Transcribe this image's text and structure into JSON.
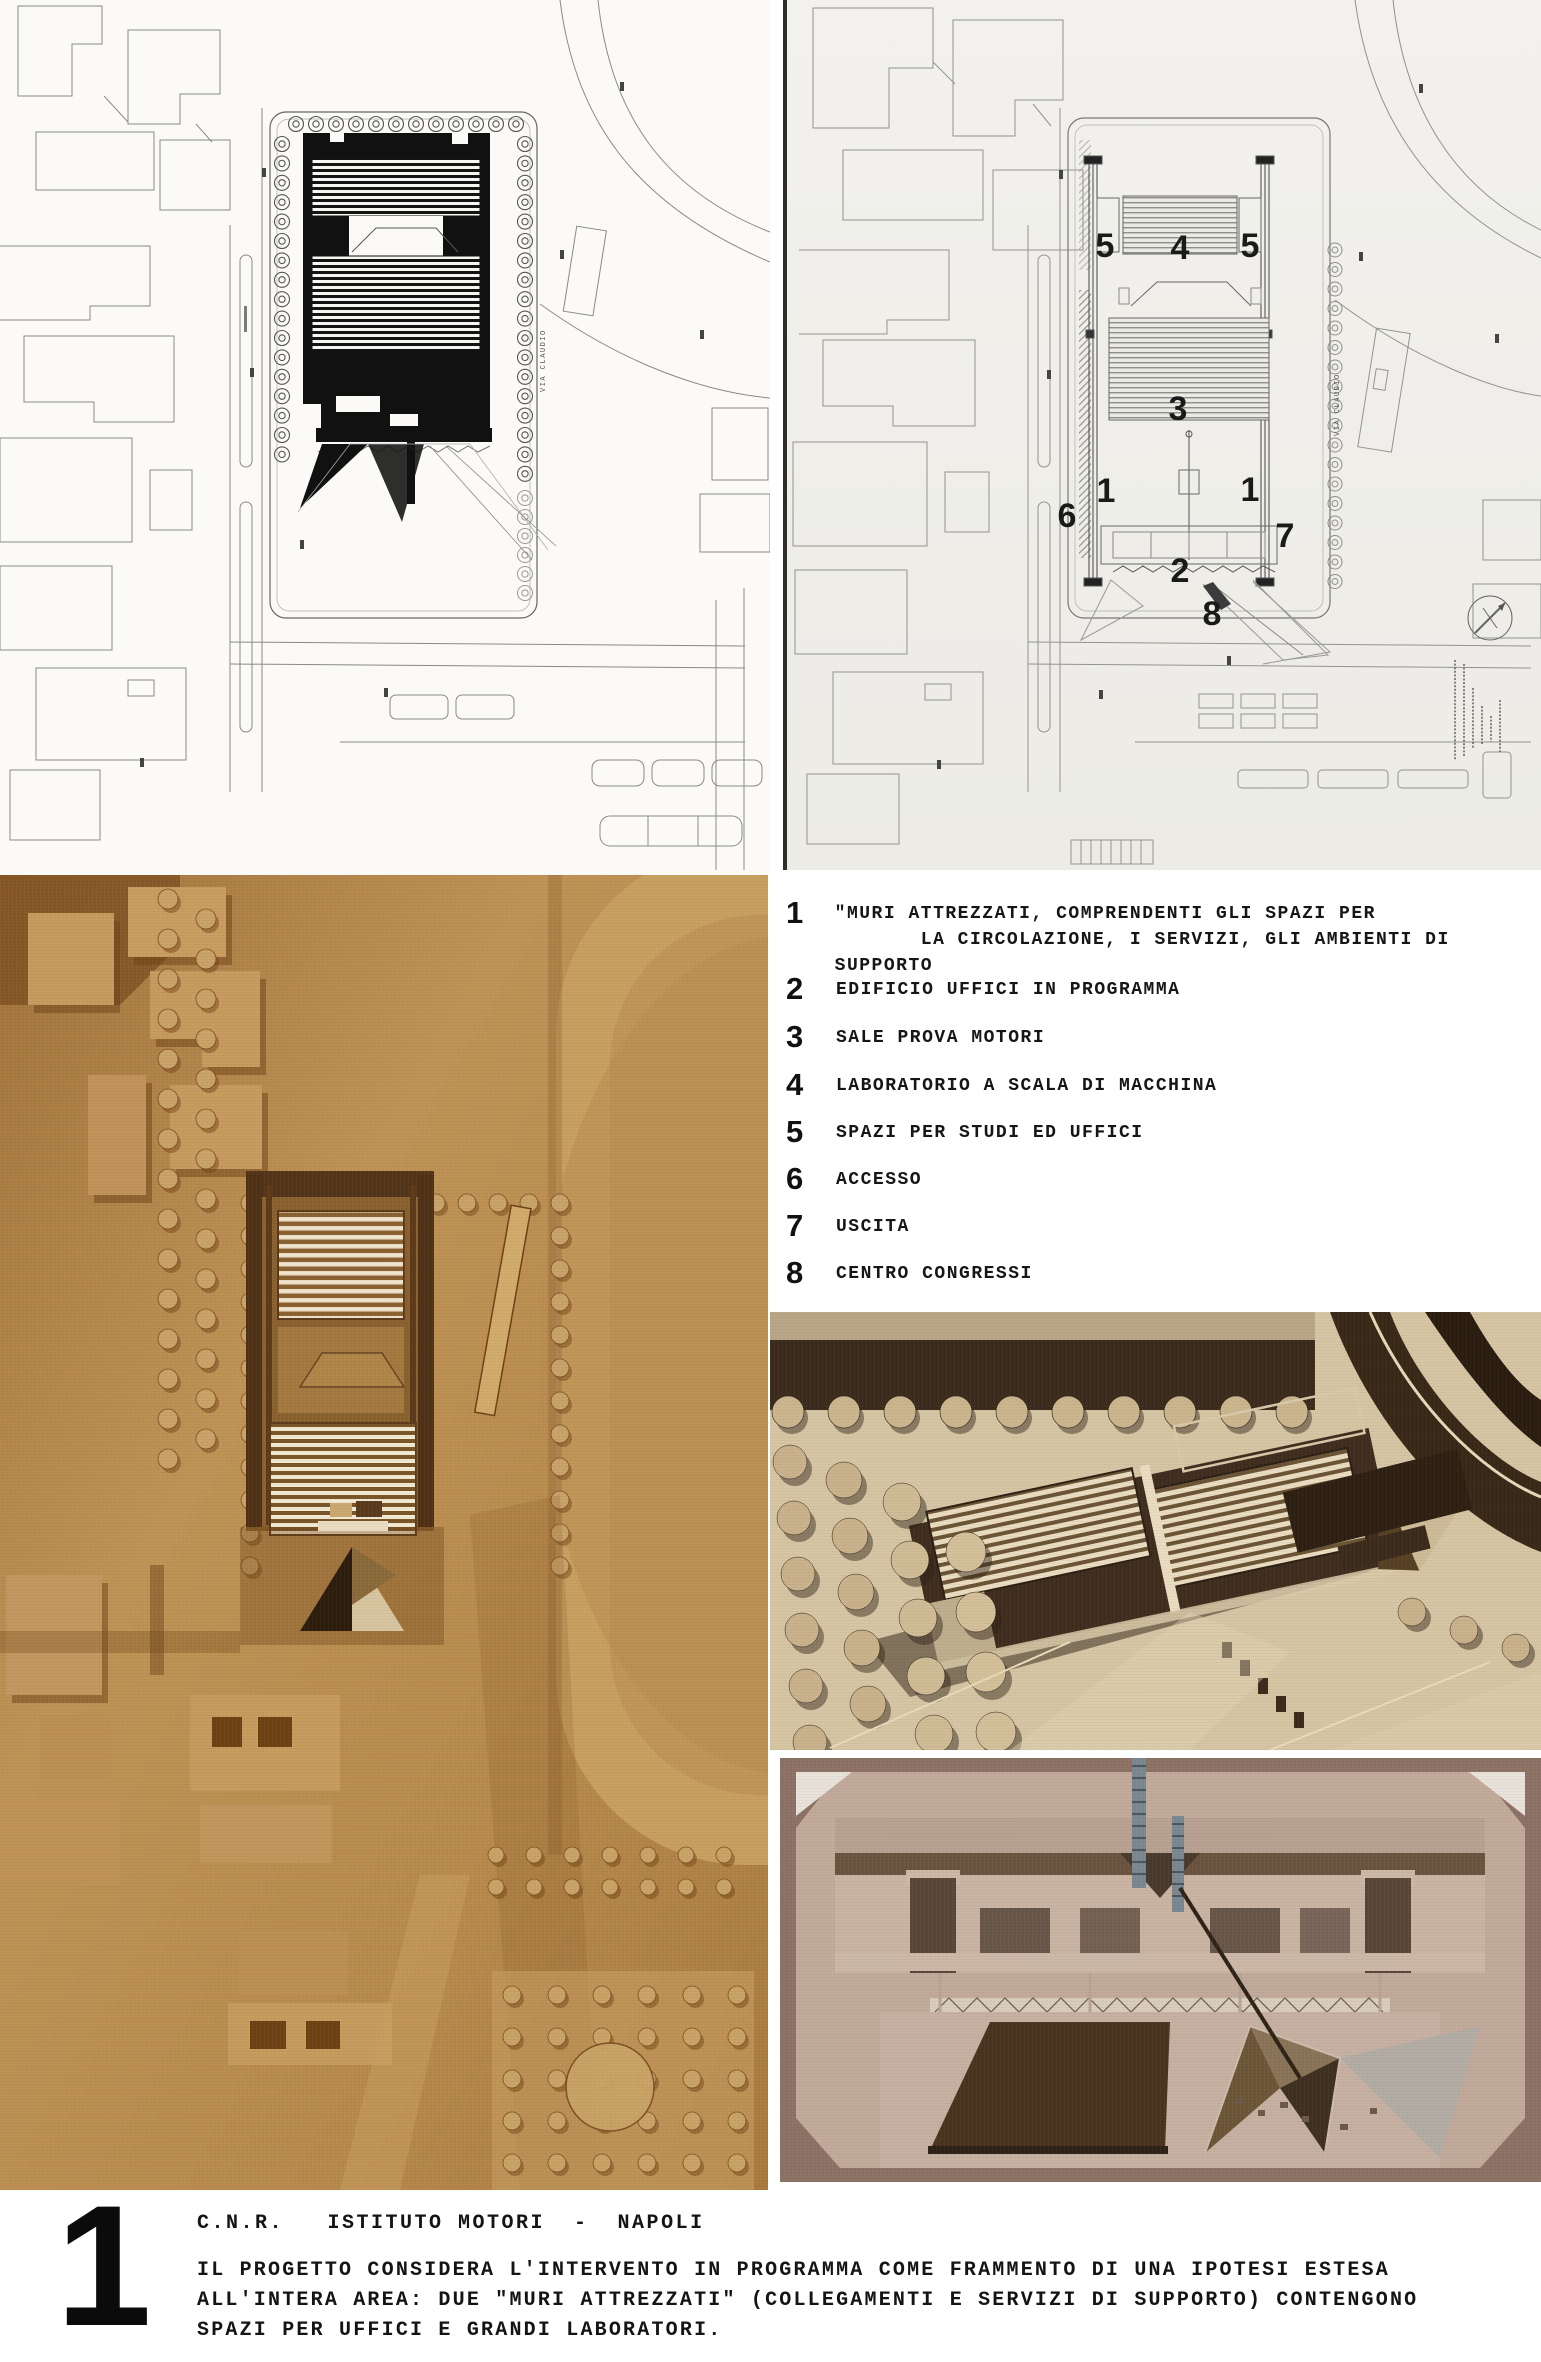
{
  "page": {
    "background": "#ffffff"
  },
  "plans": {
    "left": {
      "description": "site-plan-black-building-mass",
      "street_label": "VIA CLAUDIO"
    },
    "right": {
      "description": "site-plan-numbered-program",
      "street_label": "VIA CLAUDIO",
      "callouts": [
        "5",
        "4",
        "5",
        "3",
        "1",
        "1",
        "6",
        "7",
        "2",
        "8"
      ]
    }
  },
  "legend": {
    "items": [
      {
        "num": "1",
        "text": "\"MURI ATTREZZATI, COMPRENDENTI GLI SPAZI PER\n       LA CIRCOLAZIONE, I SERVIZI, GLI AMBIENTI DI SUPPORTO"
      },
      {
        "num": "2",
        "text": "EDIFICIO UFFICI IN PROGRAMMA"
      },
      {
        "num": "3",
        "text": "SALE PROVA MOTORI"
      },
      {
        "num": "4",
        "text": "LABORATORIO A SCALA DI MACCHINA"
      },
      {
        "num": "5",
        "text": "SPAZI PER STUDI ED UFFICI"
      },
      {
        "num": "6",
        "text": "ACCESSO"
      },
      {
        "num": "7",
        "text": "USCITA"
      },
      {
        "num": "8",
        "text": "CENTRO CONGRESSI"
      }
    ]
  },
  "caption": {
    "figure_number": "1",
    "title": "C.N.R.   ISTITUTO MOTORI  -  NAPOLI",
    "body": "IL PROGETTO CONSIDERA L'INTERVENTO IN PROGRAMMA COME FRAMMENTO DI UNA IPOTESI ESTESA\nALL'INTERA AREA: DUE \"MURI ATTREZZATI\" (COLLEGAMENTI E SERVIZI DI SUPPORTO) CONTENGONO\nSPAZI PER UFFICI E GRANDI LABORATORI."
  },
  "colors": {
    "plan_paper_left": "#fbfaf7",
    "plan_paper_right": "#f0efeb",
    "plan_ink": "#111111",
    "wood_model": "#b5834f",
    "sepia_photo": "#d6c5a3",
    "pink_photo": "#bfa698",
    "pyramid_dark": "#4a3420",
    "text_black": "#141414"
  }
}
